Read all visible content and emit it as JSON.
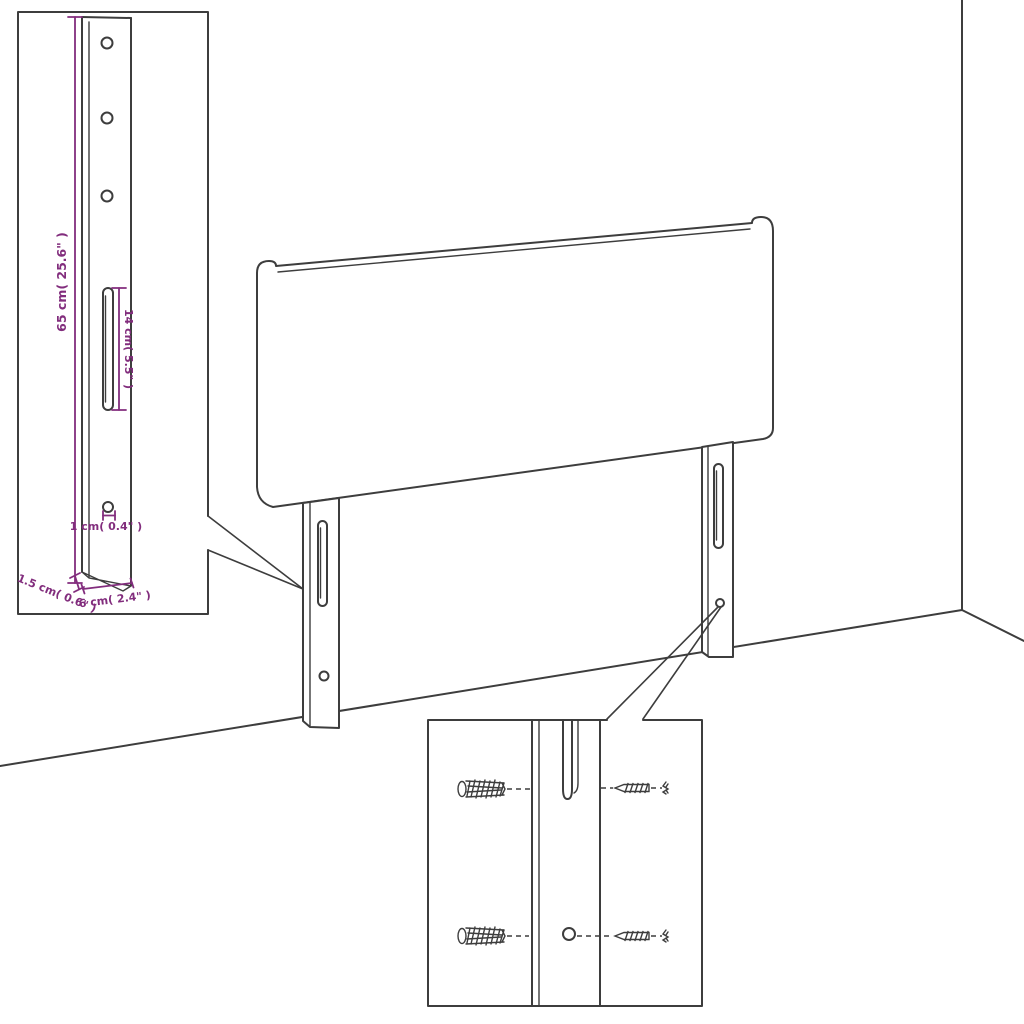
{
  "colors": {
    "line": "#3d3d3d",
    "dimension": "#822d7d",
    "background": "#ffffff"
  },
  "leg_inset": {
    "dim_height": "65 cm( 25.6\" )",
    "dim_slot": "14 cm( 5.5\" )",
    "dim_hole": "1 cm( 0.4\" )",
    "dim_thickness": "1.5 cm( 0.6\" )",
    "dim_width": "6 cm( 2.4\" )"
  },
  "hardware_inset": {
    "wall_plugs": 2,
    "screws": 2
  }
}
